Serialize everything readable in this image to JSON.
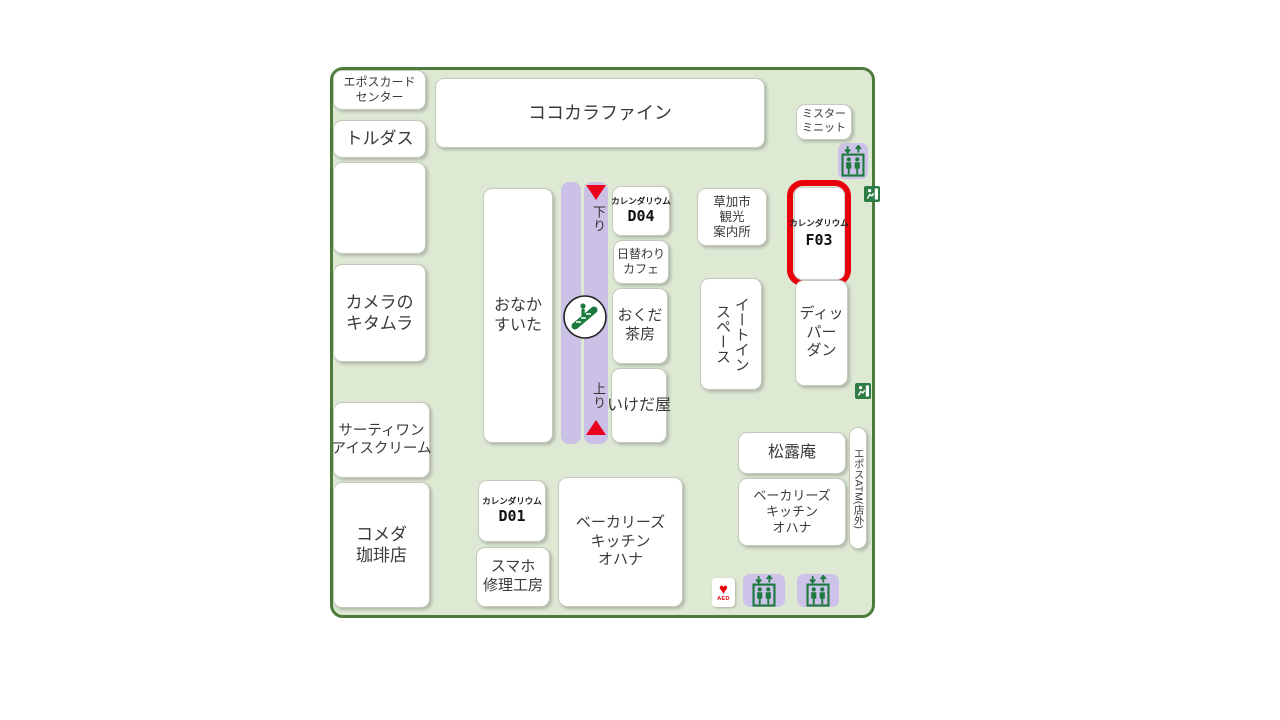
{
  "map": {
    "name": "mall-floor-map",
    "colors": {
      "map_background": "#dee9d4",
      "map_border": "#4e7b3c",
      "corridor_purple": "#cbc0e5",
      "icon_green": "#1d7a3e",
      "highlight_red": "#e8000b",
      "arrow_red": "#e8001d"
    },
    "shops": {
      "epos_card_center": "エポスカード\nセンター",
      "tordas": "トルダス",
      "camera_kitamura": "カメラの\nキタムラ",
      "thirty_one": "サーティワン\nアイスクリーム",
      "komeda_coffee": "コメダ\n珈琲店",
      "cocokara_fine": "ココカラファイン",
      "onaka_suita": "おなか\nすいた",
      "higawari_cafe": "日替わり\nカフェ",
      "okuda_sabo": "おくだ\n茶房",
      "ikedaya": "いけだ屋",
      "soka_info": "草加市\n観光\n案内所",
      "eat_in_space": "イートイン\nスペース",
      "mister_minit": "ミスター\nミニット",
      "dipper_dan": "ディッパー\nダン",
      "shoroan": "松露庵",
      "bakerys_kitchen_ohana_center": "ベーカリーズ\nキッチン\nオハナ",
      "bakerys_kitchen_ohana_right": "ベーカリーズ\nキッチン\nオハナ",
      "sumaho_repair": "スマホ\n修理工房",
      "epos_atm": "エポスATM(店外)"
    },
    "calendarium": {
      "d04": {
        "name": "カレンダリウム",
        "code": "D04"
      },
      "d01": {
        "name": "カレンダリウム",
        "code": "D01"
      },
      "f03": {
        "name": "カレンダリウム",
        "code": "F03"
      }
    },
    "labels": {
      "escalator_down": "下り",
      "escalator_up": "上り",
      "aed": "AED"
    }
  }
}
